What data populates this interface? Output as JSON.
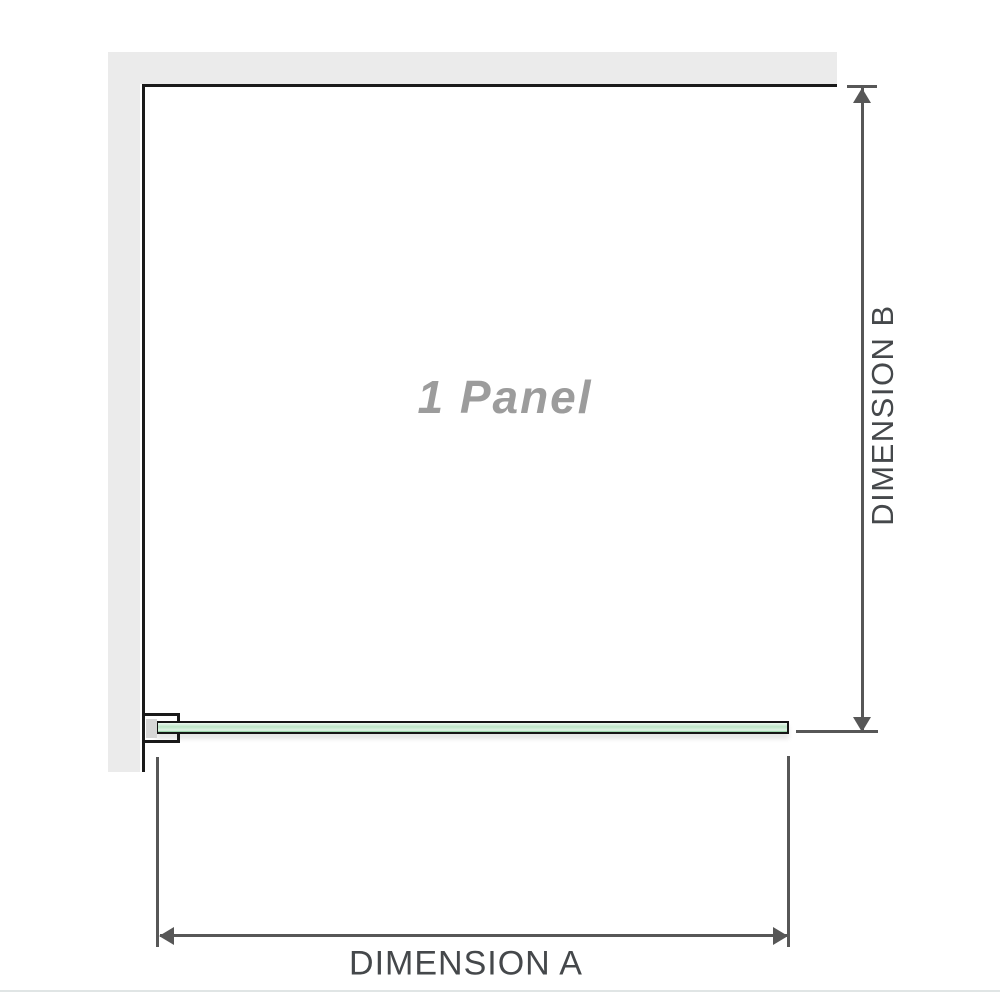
{
  "diagram": {
    "panel_label": "1 Panel",
    "dimension_a_label": "DIMENSION A",
    "dimension_b_label": "DIMENSION B"
  },
  "icons": {
    "arrow_up": "dimension-b-arrow-up",
    "arrow_down": "dimension-b-arrow-down",
    "arrow_left": "dimension-a-arrow-left",
    "arrow_right": "dimension-a-arrow-right"
  },
  "colors": {
    "wall": "#ebebeb",
    "outline": "#1a1a1a",
    "dimension": "#575757",
    "label_text": "#45484b",
    "panel_label_text": "#9c9c9c",
    "glass_light": "#eef9f1",
    "glass_mid": "#bce4c6",
    "glass_dark": "#8fcfa0",
    "bracket_pad": "#d6d6d6",
    "baseline": "#e0e5e5"
  }
}
